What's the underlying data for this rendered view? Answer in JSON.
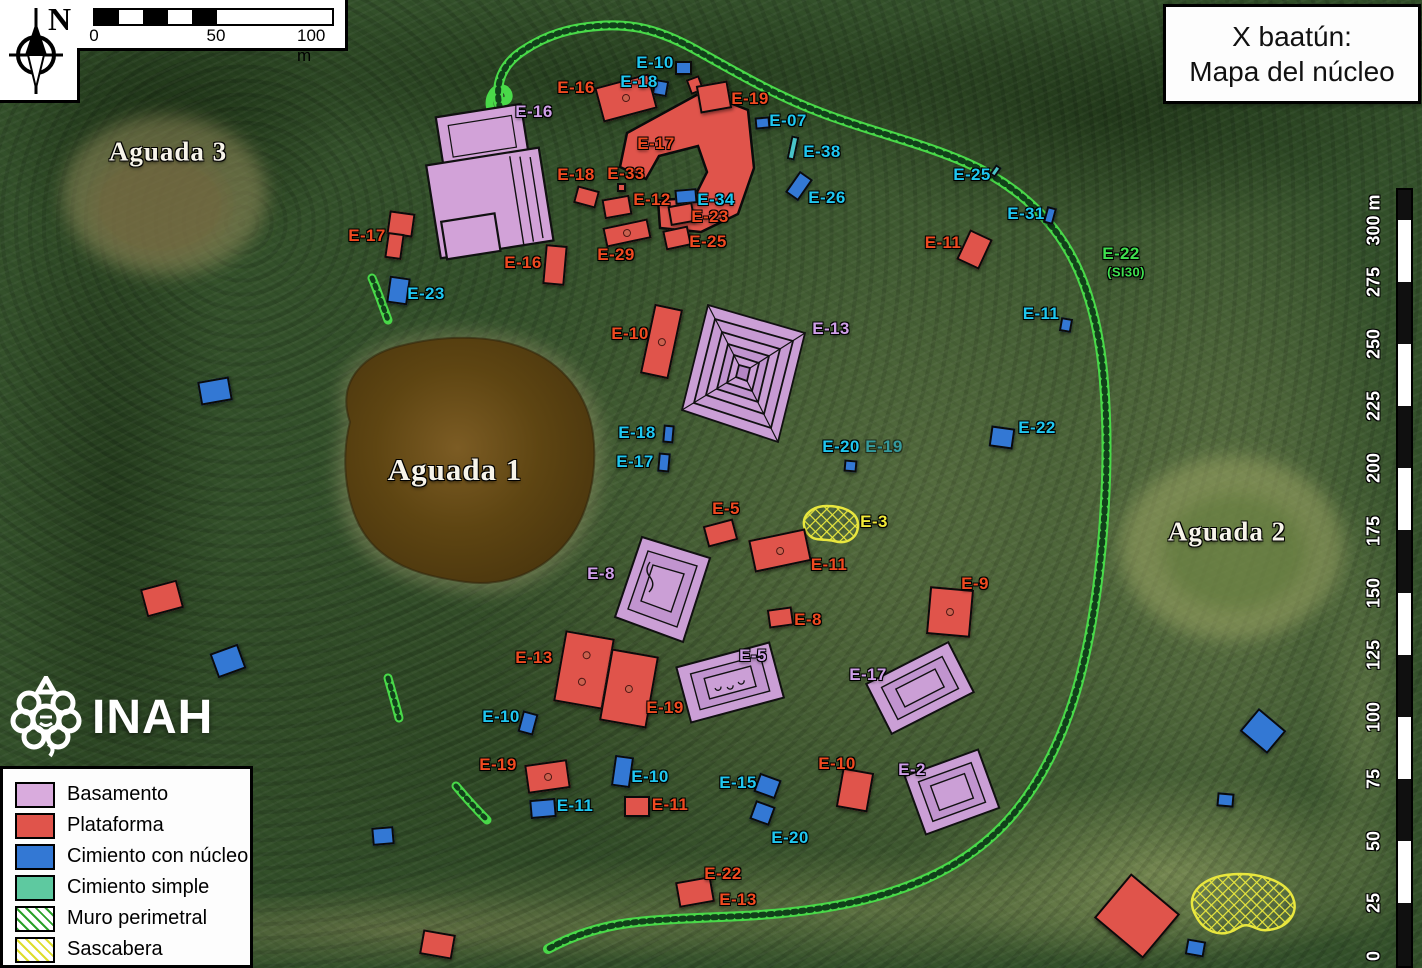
{
  "title": {
    "line1": "X baatún:",
    "line2": "Mapa del núcleo"
  },
  "compass": {
    "north_label": "N"
  },
  "scale_bar": {
    "ticks": [
      "0",
      "50",
      "100 m"
    ]
  },
  "right_ruler": {
    "labels": [
      "300 m",
      "275",
      "250",
      "225",
      "200",
      "175",
      "150",
      "125",
      "100",
      "75",
      "50",
      "25",
      "0"
    ]
  },
  "logo": {
    "text": "INAH"
  },
  "legend": {
    "items": [
      {
        "label": "Basamento",
        "swatch": "basamento"
      },
      {
        "label": "Plataforma",
        "swatch": "plataforma"
      },
      {
        "label": "Cimiento con núcleo",
        "swatch": "nucleo"
      },
      {
        "label": "Cimiento simple",
        "swatch": "simple"
      },
      {
        "label": "Muro perimetral",
        "swatch": "hatch-green"
      },
      {
        "label": "Sascabera",
        "swatch": "hatch-yellow"
      }
    ]
  },
  "colors": {
    "basamento": "#d9abdd",
    "plataforma": "#e0544b",
    "nucleo": "#3378d4",
    "simple": "#49c4c9",
    "muro_perimetral": "#49d949",
    "sascabera": "#e9e73e",
    "label_red": "#f04a20",
    "label_cyan": "#1fc7f0",
    "label_purple": "#cf9fe8",
    "label_green": "#3fe04f",
    "label_yellow": "#f2ea38"
  },
  "map_labels": [
    {
      "t": "E-10",
      "x": 655,
      "y": 63,
      "c": "cyan"
    },
    {
      "t": "E-18",
      "x": 639,
      "y": 82,
      "c": "cyan"
    },
    {
      "t": "E-16",
      "x": 576,
      "y": 88,
      "c": "red"
    },
    {
      "t": "E-19",
      "x": 750,
      "y": 99,
      "c": "red"
    },
    {
      "t": "E-16",
      "x": 534,
      "y": 112,
      "c": "purple"
    },
    {
      "t": "E-07",
      "x": 788,
      "y": 121,
      "c": "cyan"
    },
    {
      "t": "E-17",
      "x": 656,
      "y": 144,
      "c": "red"
    },
    {
      "t": "E-38",
      "x": 822,
      "y": 152,
      "c": "cyan"
    },
    {
      "t": "E-25",
      "x": 972,
      "y": 175,
      "c": "cyan"
    },
    {
      "t": "E-18",
      "x": 576,
      "y": 175,
      "c": "red"
    },
    {
      "t": "E-33",
      "x": 626,
      "y": 174,
      "c": "red"
    },
    {
      "t": "E-12",
      "x": 652,
      "y": 200,
      "c": "red"
    },
    {
      "t": "E-34",
      "x": 716,
      "y": 200,
      "c": "cyan"
    },
    {
      "t": "E-26",
      "x": 827,
      "y": 198,
      "c": "cyan"
    },
    {
      "t": "E-31",
      "x": 1026,
      "y": 214,
      "c": "cyan"
    },
    {
      "t": "E-23",
      "x": 710,
      "y": 217,
      "c": "red"
    },
    {
      "t": "E-17",
      "x": 367,
      "y": 236,
      "c": "red"
    },
    {
      "t": "E-11",
      "x": 943,
      "y": 243,
      "c": "red"
    },
    {
      "t": "E-25",
      "x": 708,
      "y": 242,
      "c": "red"
    },
    {
      "t": "E-29",
      "x": 616,
      "y": 255,
      "c": "red"
    },
    {
      "t": "E-22",
      "x": 1121,
      "y": 254,
      "c": "green"
    },
    {
      "t": "(SI30)",
      "x": 1126,
      "y": 272,
      "c": "green",
      "s": 13
    },
    {
      "t": "E-16",
      "x": 523,
      "y": 263,
      "c": "red"
    },
    {
      "t": "E-23",
      "x": 426,
      "y": 294,
      "c": "cyan"
    },
    {
      "t": "E-11",
      "x": 1041,
      "y": 314,
      "c": "cyan"
    },
    {
      "t": "E-10",
      "x": 630,
      "y": 334,
      "c": "red"
    },
    {
      "t": "E-13",
      "x": 831,
      "y": 329,
      "c": "purple"
    },
    {
      "t": "E-22",
      "x": 1037,
      "y": 428,
      "c": "cyan"
    },
    {
      "t": "E-18",
      "x": 637,
      "y": 433,
      "c": "cyan"
    },
    {
      "t": "E-17",
      "x": 635,
      "y": 462,
      "c": "cyan"
    },
    {
      "t": "E-20",
      "x": 841,
      "y": 447,
      "c": "cyan"
    },
    {
      "t": "E-19",
      "x": 884,
      "y": 447,
      "c": "cyan",
      "faded": true
    },
    {
      "t": "E-5",
      "x": 726,
      "y": 509,
      "c": "red"
    },
    {
      "t": "E-3",
      "x": 874,
      "y": 522,
      "c": "yellow"
    },
    {
      "t": "E-11",
      "x": 829,
      "y": 565,
      "c": "red"
    },
    {
      "t": "E-8",
      "x": 601,
      "y": 574,
      "c": "purple"
    },
    {
      "t": "E-9",
      "x": 975,
      "y": 584,
      "c": "red"
    },
    {
      "t": "E-8",
      "x": 808,
      "y": 620,
      "c": "red"
    },
    {
      "t": "E-13",
      "x": 534,
      "y": 658,
      "c": "red"
    },
    {
      "t": "E-5",
      "x": 753,
      "y": 656,
      "c": "purple"
    },
    {
      "t": "E-17",
      "x": 868,
      "y": 675,
      "c": "purple"
    },
    {
      "t": "E-19",
      "x": 665,
      "y": 708,
      "c": "red"
    },
    {
      "t": "E-10",
      "x": 501,
      "y": 717,
      "c": "cyan"
    },
    {
      "t": "E-10",
      "x": 837,
      "y": 764,
      "c": "red"
    },
    {
      "t": "E-2",
      "x": 912,
      "y": 770,
      "c": "purple"
    },
    {
      "t": "E-19",
      "x": 498,
      "y": 765,
      "c": "red"
    },
    {
      "t": "E-10",
      "x": 650,
      "y": 777,
      "c": "cyan"
    },
    {
      "t": "E-15",
      "x": 738,
      "y": 783,
      "c": "cyan"
    },
    {
      "t": "E-11",
      "x": 575,
      "y": 806,
      "c": "cyan"
    },
    {
      "t": "E-11",
      "x": 670,
      "y": 805,
      "c": "red"
    },
    {
      "t": "E-20",
      "x": 790,
      "y": 838,
      "c": "cyan"
    },
    {
      "t": "E-22",
      "x": 723,
      "y": 874,
      "c": "red"
    },
    {
      "t": "E-13",
      "x": 738,
      "y": 900,
      "c": "red"
    },
    {
      "t": "Aguada 3",
      "x": 168,
      "y": 152,
      "c": "white",
      "s": 27
    },
    {
      "t": "Aguada 1",
      "x": 455,
      "y": 470,
      "c": "white",
      "s": 31
    },
    {
      "t": "Aguada 2",
      "x": 1227,
      "y": 532,
      "c": "white",
      "s": 27
    }
  ],
  "structures": [
    {
      "k": "b",
      "x": 683,
      "y": 68,
      "w": 17,
      "h": 14,
      "r": 0
    },
    {
      "k": "b",
      "x": 660,
      "y": 88,
      "w": 15,
      "h": 16,
      "r": 10
    },
    {
      "k": "b",
      "x": 762,
      "y": 123,
      "w": 15,
      "h": 12,
      "r": -5
    },
    {
      "k": "s",
      "x": 793,
      "y": 148,
      "w": 8,
      "h": 24,
      "r": 12
    },
    {
      "k": "b",
      "x": 799,
      "y": 186,
      "w": 16,
      "h": 26,
      "r": 35
    },
    {
      "k": "b",
      "x": 686,
      "y": 196,
      "w": 22,
      "h": 15,
      "r": -5
    },
    {
      "k": "s",
      "x": 995,
      "y": 171,
      "w": 7,
      "h": 12,
      "r": 35
    },
    {
      "k": "b",
      "x": 1050,
      "y": 215,
      "w": 10,
      "h": 17,
      "r": 15
    },
    {
      "k": "b",
      "x": 398,
      "y": 290,
      "w": 21,
      "h": 27,
      "r": 8
    },
    {
      "k": "b",
      "x": 1066,
      "y": 325,
      "w": 12,
      "h": 14,
      "r": 10
    },
    {
      "k": "b",
      "x": 215,
      "y": 391,
      "w": 32,
      "h": 24,
      "r": -10
    },
    {
      "k": "b",
      "x": 1002,
      "y": 437,
      "w": 24,
      "h": 21,
      "r": 8
    },
    {
      "k": "b",
      "x": 668,
      "y": 434,
      "w": 11,
      "h": 18,
      "r": 5
    },
    {
      "k": "b",
      "x": 664,
      "y": 462,
      "w": 12,
      "h": 19,
      "r": 5
    },
    {
      "k": "b",
      "x": 850,
      "y": 466,
      "w": 13,
      "h": 12,
      "r": 5
    },
    {
      "k": "b",
      "x": 228,
      "y": 661,
      "w": 30,
      "h": 26,
      "r": -20
    },
    {
      "k": "b",
      "x": 528,
      "y": 723,
      "w": 16,
      "h": 22,
      "r": 15
    },
    {
      "k": "b",
      "x": 622,
      "y": 771,
      "w": 19,
      "h": 31,
      "r": 8
    },
    {
      "k": "b",
      "x": 543,
      "y": 808,
      "w": 26,
      "h": 19,
      "r": -5
    },
    {
      "k": "b",
      "x": 767,
      "y": 786,
      "w": 23,
      "h": 20,
      "r": 20
    },
    {
      "k": "b",
      "x": 762,
      "y": 813,
      "w": 21,
      "h": 20,
      "r": 20
    },
    {
      "k": "b",
      "x": 383,
      "y": 836,
      "w": 22,
      "h": 18,
      "r": -5
    },
    {
      "k": "b",
      "x": 1263,
      "y": 731,
      "w": 36,
      "h": 30,
      "r": 40
    },
    {
      "k": "b",
      "x": 1225,
      "y": 800,
      "w": 17,
      "h": 14,
      "r": 5
    },
    {
      "k": "b",
      "x": 1195,
      "y": 948,
      "w": 19,
      "h": 16,
      "r": 10
    },
    {
      "k": "p",
      "x": 626,
      "y": 98,
      "w": 56,
      "h": 36,
      "r": -15,
      "d": 1
    },
    {
      "k": "p",
      "x": 695,
      "y": 85,
      "w": 14,
      "h": 16,
      "r": -20
    },
    {
      "k": "p",
      "x": 714,
      "y": 97,
      "w": 32,
      "h": 28,
      "r": -10
    },
    {
      "k": "p",
      "x": 586,
      "y": 197,
      "w": 23,
      "h": 18,
      "r": 15
    },
    {
      "k": "p",
      "x": 621,
      "y": 187,
      "w": 9,
      "h": 9,
      "r": 0
    },
    {
      "k": "p",
      "x": 617,
      "y": 207,
      "w": 28,
      "h": 20,
      "r": -10
    },
    {
      "k": "p",
      "x": 681,
      "y": 214,
      "w": 25,
      "h": 20,
      "r": -10
    },
    {
      "k": "p",
      "x": 677,
      "y": 238,
      "w": 26,
      "h": 20,
      "r": -12
    },
    {
      "k": "p",
      "x": 627,
      "y": 233,
      "w": 46,
      "h": 20,
      "r": -12,
      "d": 1
    },
    {
      "k": "p",
      "x": 555,
      "y": 265,
      "w": 22,
      "h": 40,
      "r": 5
    },
    {
      "k": "p",
      "x": 401,
      "y": 224,
      "w": 26,
      "h": 24,
      "r": 8
    },
    {
      "k": "p",
      "x": 394,
      "y": 246,
      "w": 17,
      "h": 26,
      "r": 8
    },
    {
      "k": "p",
      "x": 974,
      "y": 249,
      "w": 25,
      "h": 33,
      "r": 25
    },
    {
      "k": "p",
      "x": 661,
      "y": 341,
      "w": 29,
      "h": 71,
      "r": 12,
      "d": 1
    },
    {
      "k": "p",
      "x": 720,
      "y": 533,
      "w": 31,
      "h": 22,
      "r": -15
    },
    {
      "k": "p",
      "x": 780,
      "y": 550,
      "w": 58,
      "h": 33,
      "r": -12,
      "d": 1
    },
    {
      "k": "p",
      "x": 780,
      "y": 617,
      "w": 25,
      "h": 19,
      "r": -8
    },
    {
      "k": "p",
      "x": 950,
      "y": 612,
      "w": 44,
      "h": 48,
      "r": 5,
      "d": 1
    },
    {
      "k": "p",
      "x": 584,
      "y": 670,
      "w": 50,
      "h": 72,
      "r": 10,
      "d": 2
    },
    {
      "k": "p",
      "x": 629,
      "y": 688,
      "w": 48,
      "h": 73,
      "r": 10,
      "d": 1
    },
    {
      "k": "p",
      "x": 547,
      "y": 776,
      "w": 43,
      "h": 29,
      "r": -8,
      "d": 1
    },
    {
      "k": "p",
      "x": 637,
      "y": 806,
      "w": 26,
      "h": 21,
      "r": 0
    },
    {
      "k": "p",
      "x": 855,
      "y": 790,
      "w": 32,
      "h": 40,
      "r": 10
    },
    {
      "k": "p",
      "x": 695,
      "y": 892,
      "w": 36,
      "h": 26,
      "r": -10
    },
    {
      "k": "p",
      "x": 162,
      "y": 598,
      "w": 38,
      "h": 29,
      "r": -15
    },
    {
      "k": "p",
      "x": 437,
      "y": 944,
      "w": 33,
      "h": 25,
      "r": 10
    },
    {
      "k": "p",
      "x": 1137,
      "y": 916,
      "w": 64,
      "h": 58,
      "r": 40
    }
  ]
}
